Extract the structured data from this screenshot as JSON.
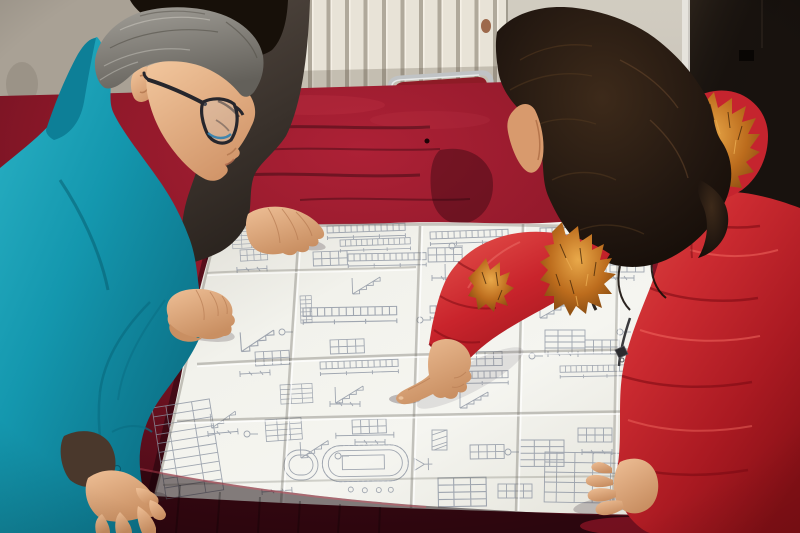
{
  "meta": {
    "kind": "photograph",
    "width": 800,
    "height": 533
  },
  "palette": {
    "wall": "#a9a195",
    "radiator_face": "#e8e3d7",
    "radiator_shade": "#b7b1a2",
    "door_light": "#cbc5b8",
    "rust": "#8a4a28",
    "door_dark": "#18120e",
    "door_frame": "#eae8e2",
    "chair_metal": "#c0c3c5",
    "chair_seat": "#8e1b26",
    "velvet_bright": "#a82136",
    "velvet_mid": "#7c1426",
    "velvet_dark": "#4a0b16",
    "velvet_shadow": "#320710",
    "paper": "#f0f0ea",
    "ink": "#8b93a1",
    "teal": "#1497ae",
    "teal_shadow": "#0d7f97",
    "man_hair": "#8f8c85",
    "skin": "#e3aa80",
    "skin_shadow": "#b97e55",
    "coat_red": "#c5242e",
    "coat_shadow": "#8e1118",
    "coat_highlight": "#e0504b",
    "fur_orange": "#c77a28",
    "fur_shadow": "#6b3a0c",
    "woman_hair": "#1f150e",
    "back_jacket": "#4a413a",
    "back_hair": "#171009"
  },
  "objects": {
    "background": [
      "wall",
      "radiator",
      "light-door",
      "dark-door",
      "chair"
    ],
    "table": "red-velvet-table",
    "document": "folded-blueprint-sheet",
    "people": [
      "worker-teal-jacket",
      "colleague-dark-jacket",
      "woman-red-coat"
    ]
  }
}
